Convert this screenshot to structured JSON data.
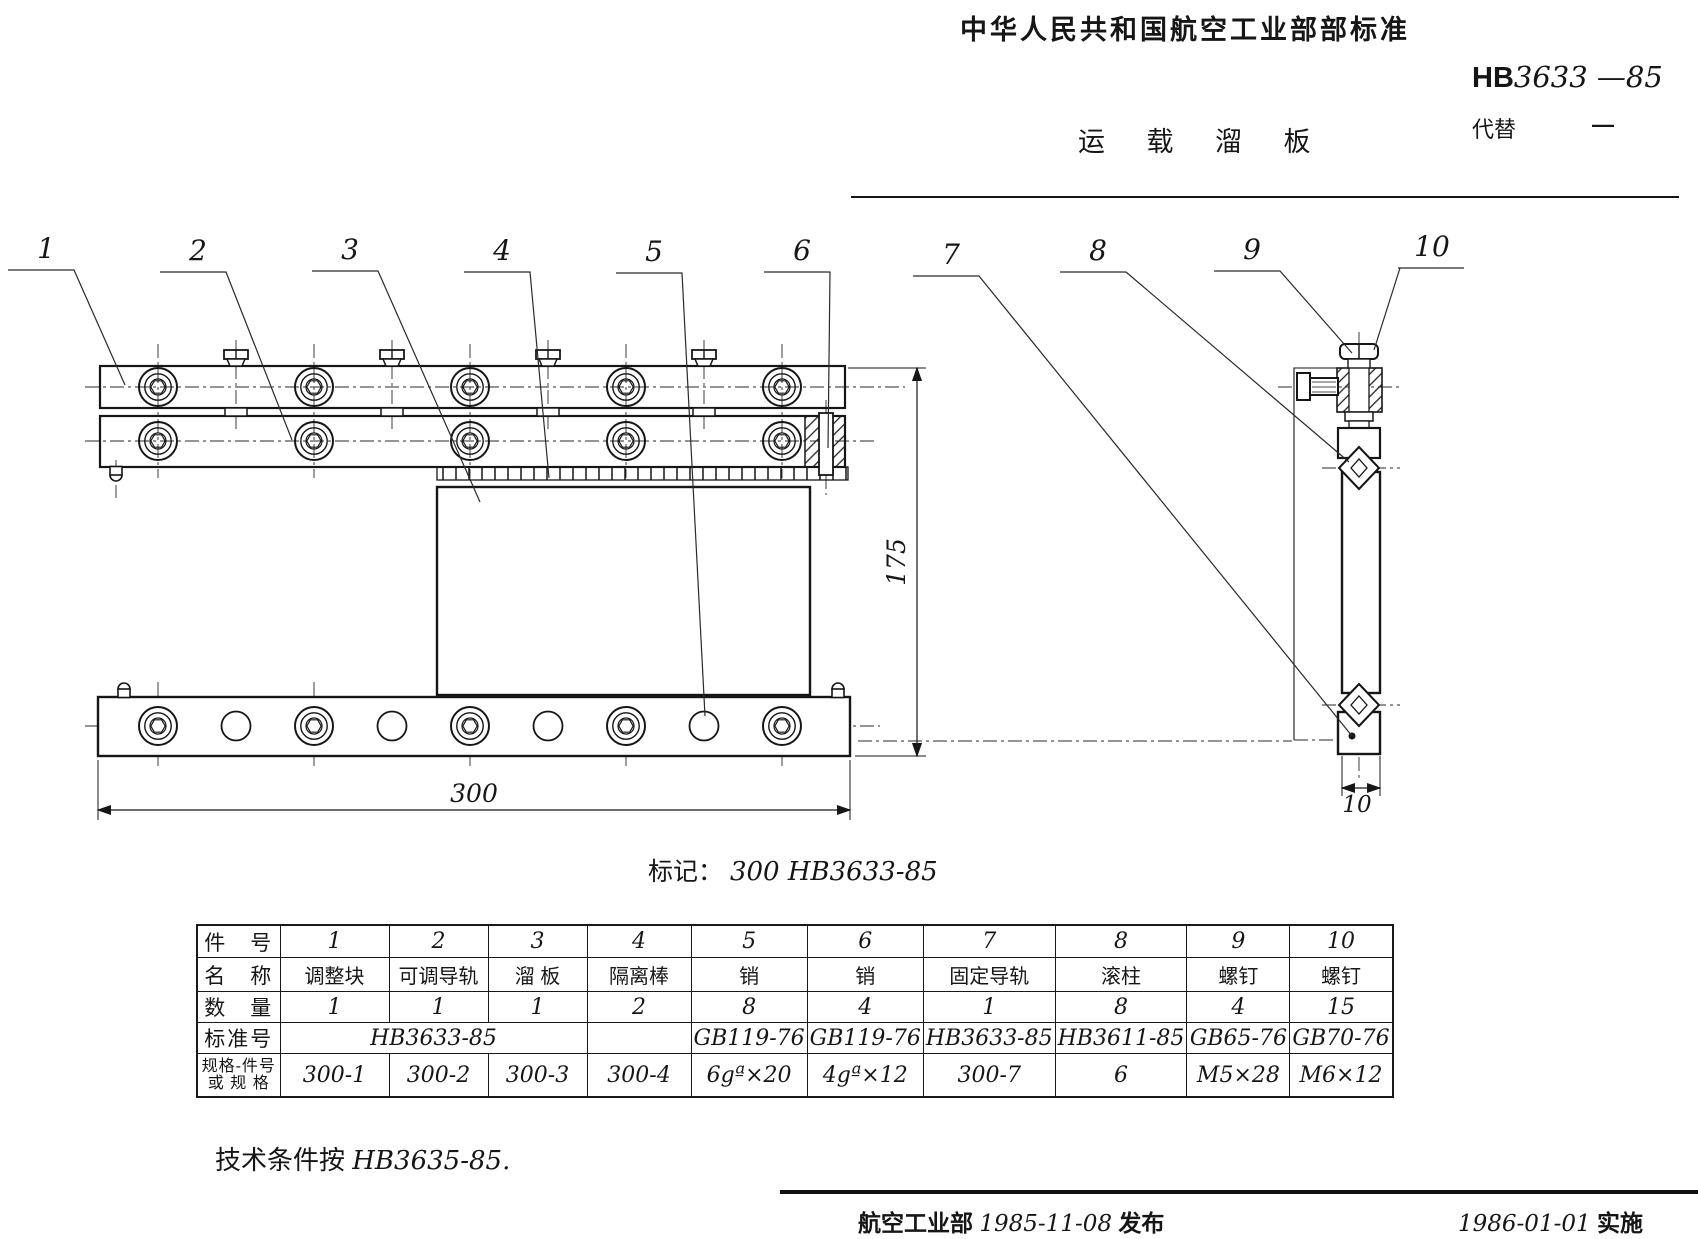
{
  "header": {
    "org": "中华人民共和国航空工业部部标准",
    "title": "运 载 溜 板",
    "code_prefix": "HB",
    "code_number": "3633",
    "code_year": " —85",
    "replace_label": "代替",
    "replace_value": "—"
  },
  "drawing": {
    "part_labels": [
      "1",
      "2",
      "3",
      "4",
      "5",
      "6",
      "7",
      "8",
      "9",
      "10"
    ],
    "dim_length": "300",
    "dim_height": "175",
    "dim_side_width": "10",
    "marking_label": "标记：",
    "marking_value": "300  HB3633-85"
  },
  "table": {
    "row_headers": [
      "件　号",
      "名　称",
      "数　量",
      "标准号",
      "规格-件号",
      "或 规 格"
    ],
    "part_no": [
      "1",
      "2",
      "3",
      "4",
      "5",
      "6",
      "7",
      "8",
      "9",
      "10"
    ],
    "names": [
      "调整块",
      "可调导轨",
      "溜 板",
      "隔离棒",
      "销",
      "销",
      "固定导轨",
      "滚柱",
      "螺钉",
      "螺钉"
    ],
    "qty": [
      "1",
      "1",
      "1",
      "2",
      "8",
      "4",
      "1",
      "8",
      "4",
      "15"
    ],
    "std_merged": "HB3633-85",
    "std": [
      "GB119-76",
      "GB119-76",
      "HB3633-85",
      "HB3611-85",
      "GB65-76",
      "GB70-76"
    ],
    "spec": [
      "300-1",
      "300-2",
      "300-3",
      "300-4",
      "6gª×20",
      "4gª×12",
      "300-7",
      "6",
      "M5×28",
      "M6×12"
    ]
  },
  "notes": {
    "tech_prefix": "技术条件按",
    "tech_value": "HB3635-85."
  },
  "footer": {
    "issuer": "航空工业部",
    "issue_date": "1985-11-08",
    "issue_word": "发布",
    "impl_date": "1986-01-01",
    "impl_word": "实施"
  }
}
